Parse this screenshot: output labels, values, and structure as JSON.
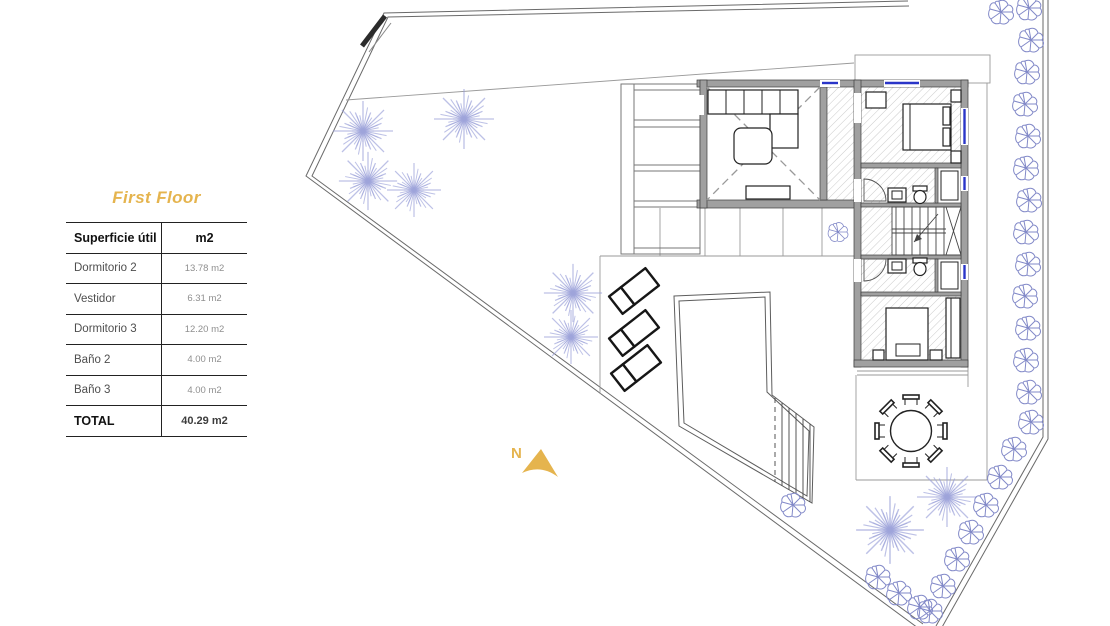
{
  "panel": {
    "title": "First Floor",
    "table": {
      "headers": [
        "Superficie útil",
        "m2"
      ],
      "rows": [
        {
          "label": "Dormitorio 2",
          "value": "13.78 m2"
        },
        {
          "label": "Vestidor",
          "value": "6.31 m2"
        },
        {
          "label": "Dormitorio 3",
          "value": "12.20 m2"
        },
        {
          "label": "Baño 2",
          "value": "4.00 m2"
        },
        {
          "label": "Baño 3",
          "value": "4.00 m2"
        }
      ],
      "total": {
        "label": "TOTAL",
        "value": "40.29 m2"
      }
    }
  },
  "plan": {
    "north_label": "N",
    "colors": {
      "gold": "#e5b44e",
      "tree": "#9aa0d8",
      "shrub": "#8289c8",
      "wall": "#a0a0a0",
      "window": "#2a35c8",
      "hatch": "#cbcbcb"
    }
  }
}
